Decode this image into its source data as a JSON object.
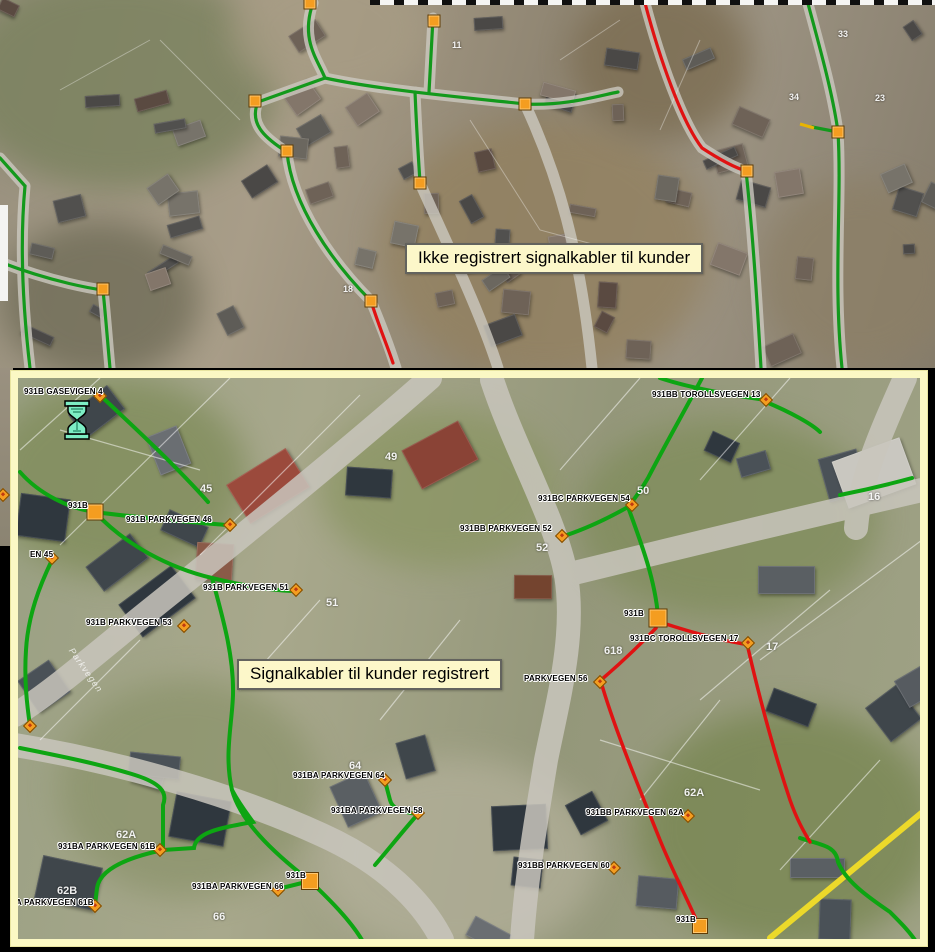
{
  "colors": {
    "cable_registered_green": "#0da512",
    "cable_unregistered_red": "#e01212",
    "node_orange": "#f49d20",
    "frame_yellow": "#fbf8c4",
    "callout_bg": "#fcf7c9",
    "road_yellow_edge": "#ecd92a"
  },
  "icons": {
    "hourglass": "hourglass-wait-cursor-icon"
  },
  "top_panel": {
    "callout": "Ikke registrert signalkabler til kunder",
    "house_numbers": [
      {
        "t": "11",
        "x": 452,
        "y": 40
      },
      {
        "t": "33",
        "x": 838,
        "y": 29
      },
      {
        "t": "34",
        "x": 789,
        "y": 92
      },
      {
        "t": "23",
        "x": 875,
        "y": 93
      },
      {
        "t": "18",
        "x": 343,
        "y": 284
      }
    ],
    "squares": [
      [
        310,
        3
      ],
      [
        434,
        21
      ],
      [
        255,
        101
      ],
      [
        287,
        151
      ],
      [
        525,
        104
      ],
      [
        420,
        183
      ],
      [
        103,
        289
      ],
      [
        838,
        132
      ],
      [
        747,
        171
      ],
      [
        371,
        301
      ]
    ]
  },
  "bottom_panel": {
    "callout": "Signalkabler til kunder registrert",
    "street_label": {
      "text": "Parkvegen"
    },
    "labels": [
      {
        "t": "931B GASEVIGEN 4",
        "x": 24,
        "y": 387
      },
      {
        "t": "931BB TOROLLSVEGEN 13",
        "x": 652,
        "y": 390
      },
      {
        "t": "931BC PARKVEGEN 54",
        "x": 538,
        "y": 494
      },
      {
        "t": "931BB PARKVEGEN 52",
        "x": 460,
        "y": 524
      },
      {
        "t": "931B",
        "x": 68,
        "y": 501
      },
      {
        "t": "931B PARKVEGEN 46",
        "x": 126,
        "y": 515
      },
      {
        "t": "EN 45",
        "x": 30,
        "y": 550
      },
      {
        "t": "931B PARKVEGEN 51",
        "x": 203,
        "y": 583
      },
      {
        "t": "931B PARKVEGEN 53",
        "x": 86,
        "y": 618
      },
      {
        "t": "931B",
        "x": 624,
        "y": 609
      },
      {
        "t": "931BC TOROLLSVEGEN 17",
        "x": 630,
        "y": 634
      },
      {
        "t": "PARKVEGEN 56",
        "x": 524,
        "y": 674
      },
      {
        "t": "931BA PARKVEGEN 64",
        "x": 293,
        "y": 771
      },
      {
        "t": "931BA PARKVEGEN 58",
        "x": 331,
        "y": 806
      },
      {
        "t": "931B",
        "x": 286,
        "y": 871
      },
      {
        "t": "931BA PARKVEGEN 66",
        "x": 192,
        "y": 882
      },
      {
        "t": "931BB PARKVEGEN 62A",
        "x": 586,
        "y": 808
      },
      {
        "t": "931BB PARKVEGEN 60",
        "x": 518,
        "y": 861
      },
      {
        "t": "931B",
        "x": 676,
        "y": 915
      },
      {
        "t": "931BA PARKVEGEN 61B",
        "x": 58,
        "y": 842
      },
      {
        "t": "A PARKVEGEN 61B",
        "x": 16,
        "y": 898
      }
    ],
    "house_numbers": [
      {
        "t": "49",
        "x": 385,
        "y": 451
      },
      {
        "t": "45",
        "x": 200,
        "y": 483
      },
      {
        "t": "50",
        "x": 637,
        "y": 485
      },
      {
        "t": "52",
        "x": 536,
        "y": 542
      },
      {
        "t": "51",
        "x": 326,
        "y": 597
      },
      {
        "t": "618",
        "x": 604,
        "y": 645
      },
      {
        "t": "17",
        "x": 766,
        "y": 641
      },
      {
        "t": "64",
        "x": 349,
        "y": 760
      },
      {
        "t": "62A",
        "x": 684,
        "y": 787
      },
      {
        "t": "62A",
        "x": 116,
        "y": 829
      },
      {
        "t": "62B",
        "x": 57,
        "y": 885
      },
      {
        "t": "66",
        "x": 213,
        "y": 911
      },
      {
        "t": "16",
        "x": 868,
        "y": 491
      }
    ],
    "diamonds": [
      [
        100,
        396
      ],
      [
        766,
        400
      ],
      [
        632,
        505
      ],
      [
        562,
        536
      ],
      [
        230,
        525
      ],
      [
        52,
        558
      ],
      [
        296,
        590
      ],
      [
        184,
        626
      ],
      [
        748,
        643
      ],
      [
        600,
        682
      ],
      [
        385,
        780
      ],
      [
        418,
        813
      ],
      [
        278,
        890
      ],
      [
        688,
        816
      ],
      [
        614,
        868
      ],
      [
        160,
        850
      ],
      [
        95,
        906
      ],
      [
        30,
        726
      ]
    ],
    "squares": [
      [
        95,
        512
      ],
      [
        658,
        618
      ],
      [
        310,
        881
      ],
      [
        700,
        926
      ]
    ],
    "edge_diamond": [
      3,
      495
    ]
  }
}
